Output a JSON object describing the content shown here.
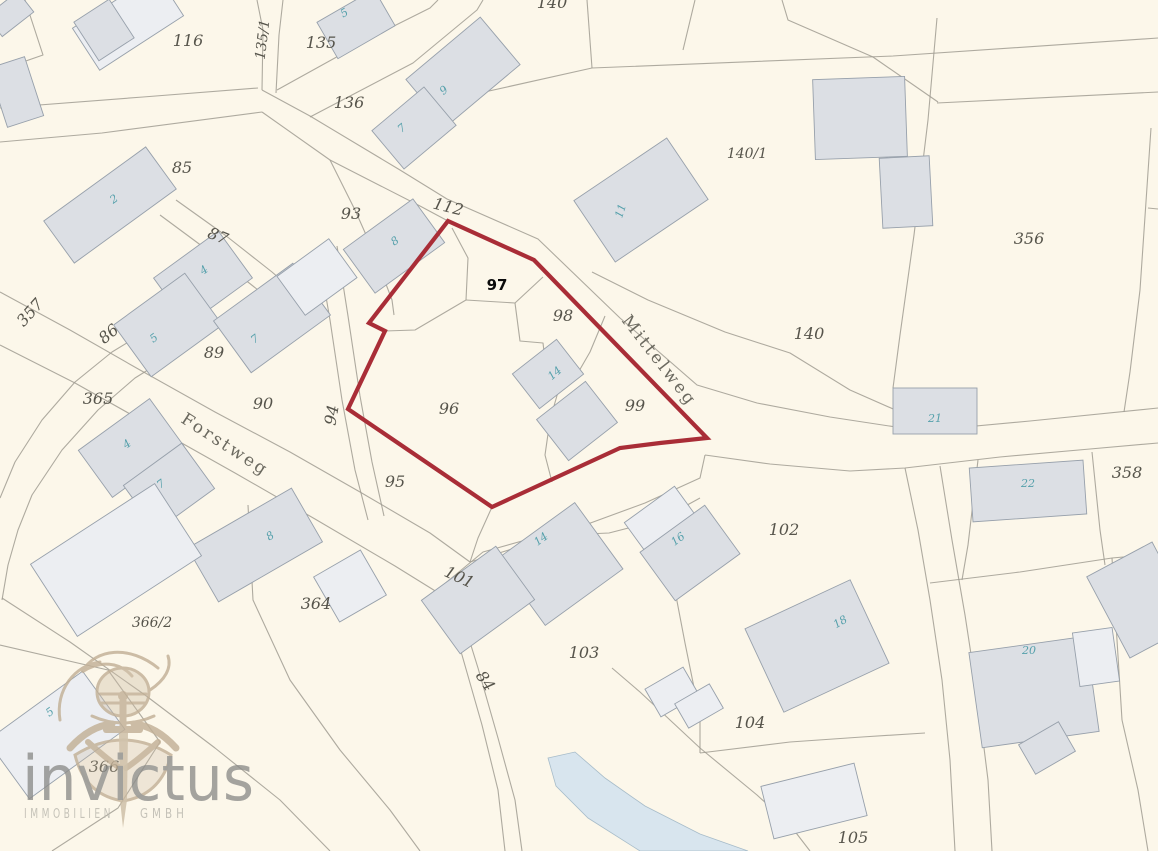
{
  "map": {
    "background": "#fcf7ea",
    "line_color": "#a09c92",
    "building_fill": "#dcdfe4",
    "building_fill_light": "#eceef2",
    "building_stroke": "#97a0ab",
    "water_fill": "#d8e5ee",
    "water_stroke": "#a7bcc9",
    "parcel_label_color": "#56544b",
    "street_label_color": "#6b695f",
    "building_label_color": "#55a0ab",
    "annotation_color": "#0b0b0b"
  },
  "highlight": {
    "parcel_label": "97",
    "annotation_x": 497,
    "annotation_y": 290,
    "outline_color": "#a92d37",
    "outline_width": 4.2,
    "points": [
      [
        448,
        221
      ],
      [
        534,
        260
      ],
      [
        707,
        438
      ],
      [
        660,
        443
      ],
      [
        620,
        448
      ],
      [
        492,
        507
      ],
      [
        348,
        409
      ],
      [
        385,
        331
      ],
      [
        369,
        323
      ]
    ]
  },
  "streets": [
    {
      "name": "Mittelweg",
      "x": 655,
      "y": 364,
      "rot": 52
    },
    {
      "name": "Forstweg",
      "x": 222,
      "y": 449,
      "rot": 33
    }
  ],
  "parcel_labels": [
    {
      "t": "116",
      "x": 188,
      "y": 46
    },
    {
      "t": "135/1",
      "x": 267,
      "y": 40,
      "r": -83
    },
    {
      "t": "135",
      "x": 321,
      "y": 48
    },
    {
      "t": "136",
      "x": 349,
      "y": 108
    },
    {
      "t": "140",
      "x": 552,
      "y": 8
    },
    {
      "t": "140/1",
      "x": 747,
      "y": 158
    },
    {
      "t": "356",
      "x": 1029,
      "y": 244
    },
    {
      "t": "85",
      "x": 182,
      "y": 173
    },
    {
      "t": "93",
      "x": 351,
      "y": 219
    },
    {
      "t": "112",
      "x": 447,
      "y": 212,
      "r": 14
    },
    {
      "t": "87",
      "x": 216,
      "y": 241,
      "r": 22
    },
    {
      "t": "357",
      "x": 34,
      "y": 316,
      "r": -48
    },
    {
      "t": "86",
      "x": 112,
      "y": 338,
      "r": -40
    },
    {
      "t": "89",
      "x": 214,
      "y": 358
    },
    {
      "t": "90",
      "x": 263,
      "y": 409
    },
    {
      "t": "94",
      "x": 337,
      "y": 416,
      "r": -80
    },
    {
      "t": "98",
      "x": 563,
      "y": 321
    },
    {
      "t": "96",
      "x": 449,
      "y": 414
    },
    {
      "t": "99",
      "x": 635,
      "y": 411
    },
    {
      "t": "140",
      "x": 809,
      "y": 339
    },
    {
      "t": "365",
      "x": 98,
      "y": 404
    },
    {
      "t": "95",
      "x": 395,
      "y": 487
    },
    {
      "t": "358",
      "x": 1127,
      "y": 478
    },
    {
      "t": "102",
      "x": 784,
      "y": 535
    },
    {
      "t": "101",
      "x": 457,
      "y": 582,
      "r": 25
    },
    {
      "t": "84",
      "x": 481,
      "y": 684,
      "r": 55
    },
    {
      "t": "103",
      "x": 584,
      "y": 658
    },
    {
      "t": "364",
      "x": 316,
      "y": 609
    },
    {
      "t": "366/2",
      "x": 152,
      "y": 627
    },
    {
      "t": "104",
      "x": 750,
      "y": 728
    },
    {
      "t": "105",
      "x": 853,
      "y": 843
    },
    {
      "t": "366",
      "x": 104,
      "y": 772
    }
  ],
  "building_labels": [
    {
      "t": "2",
      "x": 116,
      "y": 202,
      "r": -35
    },
    {
      "t": "5",
      "x": 346,
      "y": 16,
      "r": -30
    },
    {
      "t": "9",
      "x": 446,
      "y": 93,
      "r": -40
    },
    {
      "t": "7",
      "x": 404,
      "y": 131,
      "r": -40
    },
    {
      "t": "8",
      "x": 397,
      "y": 244,
      "r": -36
    },
    {
      "t": "11",
      "x": 624,
      "y": 212,
      "r": -72
    },
    {
      "t": "4",
      "x": 206,
      "y": 273,
      "r": -36
    },
    {
      "t": "5",
      "x": 156,
      "y": 341,
      "r": -36
    },
    {
      "t": "7",
      "x": 257,
      "y": 342,
      "r": -36
    },
    {
      "t": "4",
      "x": 129,
      "y": 447,
      "r": -36
    },
    {
      "t": "7",
      "x": 163,
      "y": 487,
      "r": -36
    },
    {
      "t": "14",
      "x": 557,
      "y": 376,
      "r": -40
    },
    {
      "t": "21",
      "x": 935,
      "y": 422,
      "r": 0
    },
    {
      "t": "22",
      "x": 1028,
      "y": 487,
      "r": 0
    },
    {
      "t": "14",
      "x": 543,
      "y": 542,
      "r": -36
    },
    {
      "t": "16",
      "x": 680,
      "y": 542,
      "r": -36
    },
    {
      "t": "8",
      "x": 272,
      "y": 539,
      "r": -33
    },
    {
      "t": "18",
      "x": 842,
      "y": 625,
      "r": -30
    },
    {
      "t": "20",
      "x": 1029,
      "y": 654,
      "r": 0
    },
    {
      "t": "5",
      "x": 52,
      "y": 715,
      "r": -36
    }
  ],
  "buildings": [
    [
      10,
      14,
      40,
      26,
      -38,
      0
    ],
    [
      128,
      22,
      100,
      50,
      -33,
      1
    ],
    [
      104,
      30,
      42,
      46,
      -33,
      0
    ],
    [
      16,
      92,
      38,
      62,
      -18,
      0
    ],
    [
      110,
      205,
      126,
      52,
      -36,
      0
    ],
    [
      356,
      24,
      66,
      42,
      -30,
      0
    ],
    [
      463,
      72,
      97,
      62,
      -40,
      0
    ],
    [
      414,
      128,
      68,
      50,
      -40,
      0
    ],
    [
      394,
      246,
      86,
      54,
      -36,
      0
    ],
    [
      641,
      200,
      112,
      74,
      -34,
      0
    ],
    [
      860,
      118,
      92,
      80,
      -2,
      0
    ],
    [
      906,
      192,
      50,
      70,
      -3,
      0
    ],
    [
      203,
      278,
      80,
      58,
      -36,
      0
    ],
    [
      168,
      325,
      88,
      64,
      -36,
      0
    ],
    [
      272,
      318,
      98,
      64,
      -36,
      0
    ],
    [
      317,
      277,
      64,
      48,
      -36,
      1
    ],
    [
      131,
      448,
      88,
      58,
      -36,
      0
    ],
    [
      169,
      487,
      72,
      56,
      -36,
      0
    ],
    [
      548,
      374,
      56,
      44,
      -38,
      0
    ],
    [
      577,
      421,
      62,
      52,
      -38,
      0
    ],
    [
      935,
      411,
      84,
      46,
      0,
      0
    ],
    [
      1028,
      491,
      114,
      54,
      -4,
      0
    ],
    [
      560,
      564,
      96,
      82,
      -36,
      0
    ],
    [
      478,
      600,
      92,
      66,
      -36,
      0
    ],
    [
      660,
      519,
      62,
      36,
      -36,
      1
    ],
    [
      690,
      553,
      80,
      60,
      -36,
      0
    ],
    [
      255,
      545,
      120,
      62,
      -30,
      0
    ],
    [
      350,
      586,
      54,
      52,
      -30,
      1
    ],
    [
      116,
      560,
      148,
      86,
      -33,
      1
    ],
    [
      56,
      735,
      118,
      72,
      -36,
      1
    ],
    [
      817,
      646,
      116,
      92,
      -25,
      0
    ],
    [
      1034,
      692,
      118,
      96,
      -8,
      0
    ],
    [
      1096,
      657,
      40,
      54,
      -8,
      1
    ],
    [
      814,
      801,
      96,
      54,
      -14,
      1
    ],
    [
      1047,
      748,
      46,
      34,
      -30,
      0
    ],
    [
      1141,
      600,
      74,
      92,
      -28,
      0
    ],
    [
      672,
      692,
      44,
      32,
      -30,
      1
    ],
    [
      699,
      706,
      40,
      28,
      -30,
      1
    ]
  ],
  "boundaries": [
    [
      [
        25,
        0
      ],
      [
        43,
        55
      ],
      [
        0,
        70
      ]
    ],
    [
      [
        0,
        108
      ],
      [
        143,
        97
      ],
      [
        258,
        88
      ]
    ],
    [
      [
        0,
        142
      ],
      [
        102,
        133
      ],
      [
        262,
        112
      ]
    ],
    [
      [
        257,
        0
      ],
      [
        263,
        30
      ],
      [
        262,
        90
      ]
    ],
    [
      [
        283,
        0
      ],
      [
        279,
        35
      ],
      [
        276,
        93
      ]
    ],
    [
      [
        262,
        90
      ],
      [
        310,
        116
      ],
      [
        400,
        170
      ],
      [
        447,
        199
      ],
      [
        538,
        239
      ],
      [
        620,
        318
      ],
      [
        697,
        385
      ],
      [
        757,
        403
      ],
      [
        830,
        417
      ],
      [
        922,
        431
      ],
      [
        1030,
        421
      ],
      [
        1158,
        408
      ]
    ],
    [
      [
        262,
        112
      ],
      [
        330,
        160
      ],
      [
        420,
        206
      ],
      [
        448,
        221
      ]
    ],
    [
      [
        277,
        90
      ],
      [
        380,
        33
      ],
      [
        430,
        8
      ],
      [
        438,
        0
      ]
    ],
    [
      [
        310,
        117
      ],
      [
        413,
        63
      ],
      [
        477,
        10
      ],
      [
        483,
        0
      ]
    ],
    [
      [
        587,
        0
      ],
      [
        592,
        68
      ]
    ],
    [
      [
        695,
        0
      ],
      [
        683,
        50
      ]
    ],
    [
      [
        480,
        93
      ],
      [
        592,
        68
      ],
      [
        893,
        56
      ],
      [
        1158,
        38
      ]
    ],
    [
      [
        937,
        103
      ],
      [
        1158,
        92
      ]
    ],
    [
      [
        937,
        18
      ],
      [
        928,
        120
      ],
      [
        914,
        235
      ],
      [
        900,
        335
      ],
      [
        893,
        388
      ]
    ],
    [
      [
        1151,
        128
      ],
      [
        1140,
        290
      ],
      [
        1130,
        372
      ],
      [
        1124,
        412
      ]
    ],
    [
      [
        1148,
        208
      ],
      [
        1158,
        209
      ]
    ],
    [
      [
        592,
        272
      ],
      [
        648,
        300
      ],
      [
        725,
        332
      ],
      [
        790,
        353
      ],
      [
        850,
        390
      ],
      [
        900,
        412
      ],
      [
        922,
        431
      ]
    ],
    [
      [
        0,
        292
      ],
      [
        70,
        330
      ],
      [
        140,
        370
      ],
      [
        215,
        412
      ],
      [
        290,
        452
      ],
      [
        360,
        492
      ],
      [
        430,
        533
      ],
      [
        470,
        562
      ]
    ],
    [
      [
        0,
        345
      ],
      [
        75,
        383
      ],
      [
        155,
        428
      ],
      [
        235,
        473
      ],
      [
        315,
        519
      ],
      [
        395,
        566
      ],
      [
        445,
        597
      ]
    ],
    [
      [
        470,
        562
      ],
      [
        525,
        545
      ],
      [
        585,
        525
      ],
      [
        645,
        503
      ],
      [
        700,
        478
      ],
      [
        705,
        455
      ]
    ],
    [
      [
        425,
        600
      ],
      [
        483,
        552
      ],
      [
        540,
        536
      ],
      [
        609,
        533
      ],
      [
        660,
        520
      ],
      [
        700,
        498
      ]
    ],
    [
      [
        445,
        597
      ],
      [
        462,
        655
      ],
      [
        482,
        725
      ],
      [
        498,
        790
      ],
      [
        505,
        851
      ]
    ],
    [
      [
        460,
        610
      ],
      [
        478,
        668
      ],
      [
        498,
        738
      ],
      [
        515,
        800
      ],
      [
        522,
        851
      ]
    ],
    [
      [
        318,
        250
      ],
      [
        330,
        320
      ],
      [
        342,
        400
      ],
      [
        355,
        470
      ],
      [
        368,
        520
      ]
    ],
    [
      [
        337,
        246
      ],
      [
        348,
        316
      ],
      [
        360,
        396
      ],
      [
        372,
        462
      ],
      [
        384,
        516
      ]
    ],
    [
      [
        176,
        200
      ],
      [
        225,
        235
      ],
      [
        272,
        272
      ],
      [
        310,
        305
      ]
    ],
    [
      [
        160,
        215
      ],
      [
        210,
        252
      ],
      [
        258,
        290
      ],
      [
        296,
        322
      ]
    ],
    [
      [
        148,
        330
      ],
      [
        112,
        352
      ],
      [
        75,
        382
      ],
      [
        42,
        420
      ],
      [
        15,
        462
      ],
      [
        0,
        498
      ]
    ],
    [
      [
        172,
        355
      ],
      [
        135,
        378
      ],
      [
        98,
        410
      ],
      [
        62,
        450
      ],
      [
        32,
        495
      ],
      [
        18,
        530
      ],
      [
        8,
        565
      ],
      [
        2,
        600
      ]
    ],
    [
      [
        0,
        645
      ],
      [
        108,
        670
      ],
      [
        160,
        742
      ]
    ],
    [
      [
        160,
        742
      ],
      [
        118,
        808
      ],
      [
        52,
        851
      ]
    ],
    [
      [
        248,
        505
      ],
      [
        253,
        600
      ],
      [
        290,
        680
      ],
      [
        340,
        750
      ],
      [
        390,
        810
      ],
      [
        420,
        851
      ]
    ],
    [
      [
        2,
        598
      ],
      [
        70,
        642
      ],
      [
        145,
        695
      ],
      [
        215,
        748
      ],
      [
        280,
        800
      ],
      [
        330,
        851
      ]
    ],
    [
      [
        658,
        502
      ],
      [
        672,
        575
      ],
      [
        685,
        643
      ],
      [
        700,
        717
      ],
      [
        700,
        753
      ]
    ],
    [
      [
        700,
        753
      ],
      [
        790,
        742
      ],
      [
        862,
        737
      ],
      [
        925,
        733
      ]
    ],
    [
      [
        612,
        668
      ],
      [
        640,
        692
      ],
      [
        700,
        748
      ],
      [
        757,
        795
      ],
      [
        790,
        825
      ],
      [
        810,
        851
      ]
    ],
    [
      [
        705,
        455
      ],
      [
        770,
        464
      ],
      [
        850,
        471
      ],
      [
        905,
        468
      ],
      [
        1000,
        457
      ],
      [
        1090,
        449
      ],
      [
        1158,
        443
      ]
    ],
    [
      [
        905,
        468
      ],
      [
        918,
        530
      ],
      [
        930,
        600
      ],
      [
        942,
        680
      ],
      [
        950,
        760
      ],
      [
        955,
        851
      ]
    ],
    [
      [
        940,
        466
      ],
      [
        952,
        540
      ],
      [
        965,
        615
      ],
      [
        978,
        700
      ],
      [
        988,
        780
      ],
      [
        992,
        851
      ]
    ],
    [
      [
        978,
        460
      ],
      [
        968,
        545
      ],
      [
        962,
        580
      ]
    ],
    [
      [
        1092,
        452
      ],
      [
        1100,
        530
      ],
      [
        1105,
        565
      ]
    ],
    [
      [
        930,
        583
      ],
      [
        1020,
        572
      ],
      [
        1112,
        558
      ],
      [
        1158,
        554
      ]
    ],
    [
      [
        1112,
        558
      ],
      [
        1117,
        640
      ],
      [
        1122,
        720
      ]
    ],
    [
      [
        1122,
        720
      ],
      [
        1138,
        790
      ],
      [
        1148,
        851
      ]
    ],
    [
      [
        782,
        0
      ],
      [
        788,
        20
      ],
      [
        873,
        57
      ],
      [
        938,
        102
      ]
    ],
    [
      [
        452,
        228
      ],
      [
        468,
        258
      ],
      [
        466,
        300
      ],
      [
        415,
        330
      ],
      [
        385,
        331
      ]
    ],
    [
      [
        466,
        300
      ],
      [
        515,
        303
      ],
      [
        543,
        277
      ]
    ],
    [
      [
        515,
        303
      ],
      [
        520,
        341
      ],
      [
        543,
        343
      ],
      [
        546,
        368
      ],
      [
        560,
        385
      ]
    ],
    [
      [
        605,
        316
      ],
      [
        590,
        352
      ],
      [
        575,
        378
      ],
      [
        560,
        385
      ]
    ],
    [
      [
        560,
        385
      ],
      [
        550,
        420
      ],
      [
        545,
        455
      ],
      [
        552,
        482
      ]
    ],
    [
      [
        492,
        507
      ],
      [
        478,
        538
      ],
      [
        470,
        562
      ]
    ],
    [
      [
        330,
        160
      ],
      [
        355,
        210
      ],
      [
        375,
        255
      ],
      [
        392,
        300
      ],
      [
        394,
        315
      ]
    ]
  ],
  "water": {
    "points": [
      [
        548,
        758
      ],
      [
        575,
        752
      ],
      [
        605,
        778
      ],
      [
        645,
        806
      ],
      [
        700,
        834
      ],
      [
        748,
        851
      ],
      [
        640,
        851
      ],
      [
        588,
        818
      ],
      [
        556,
        786
      ]
    ]
  },
  "logo": {
    "name": "invictus",
    "line2_left": "IMMOBILIEN",
    "line2_right": "GMBH"
  }
}
